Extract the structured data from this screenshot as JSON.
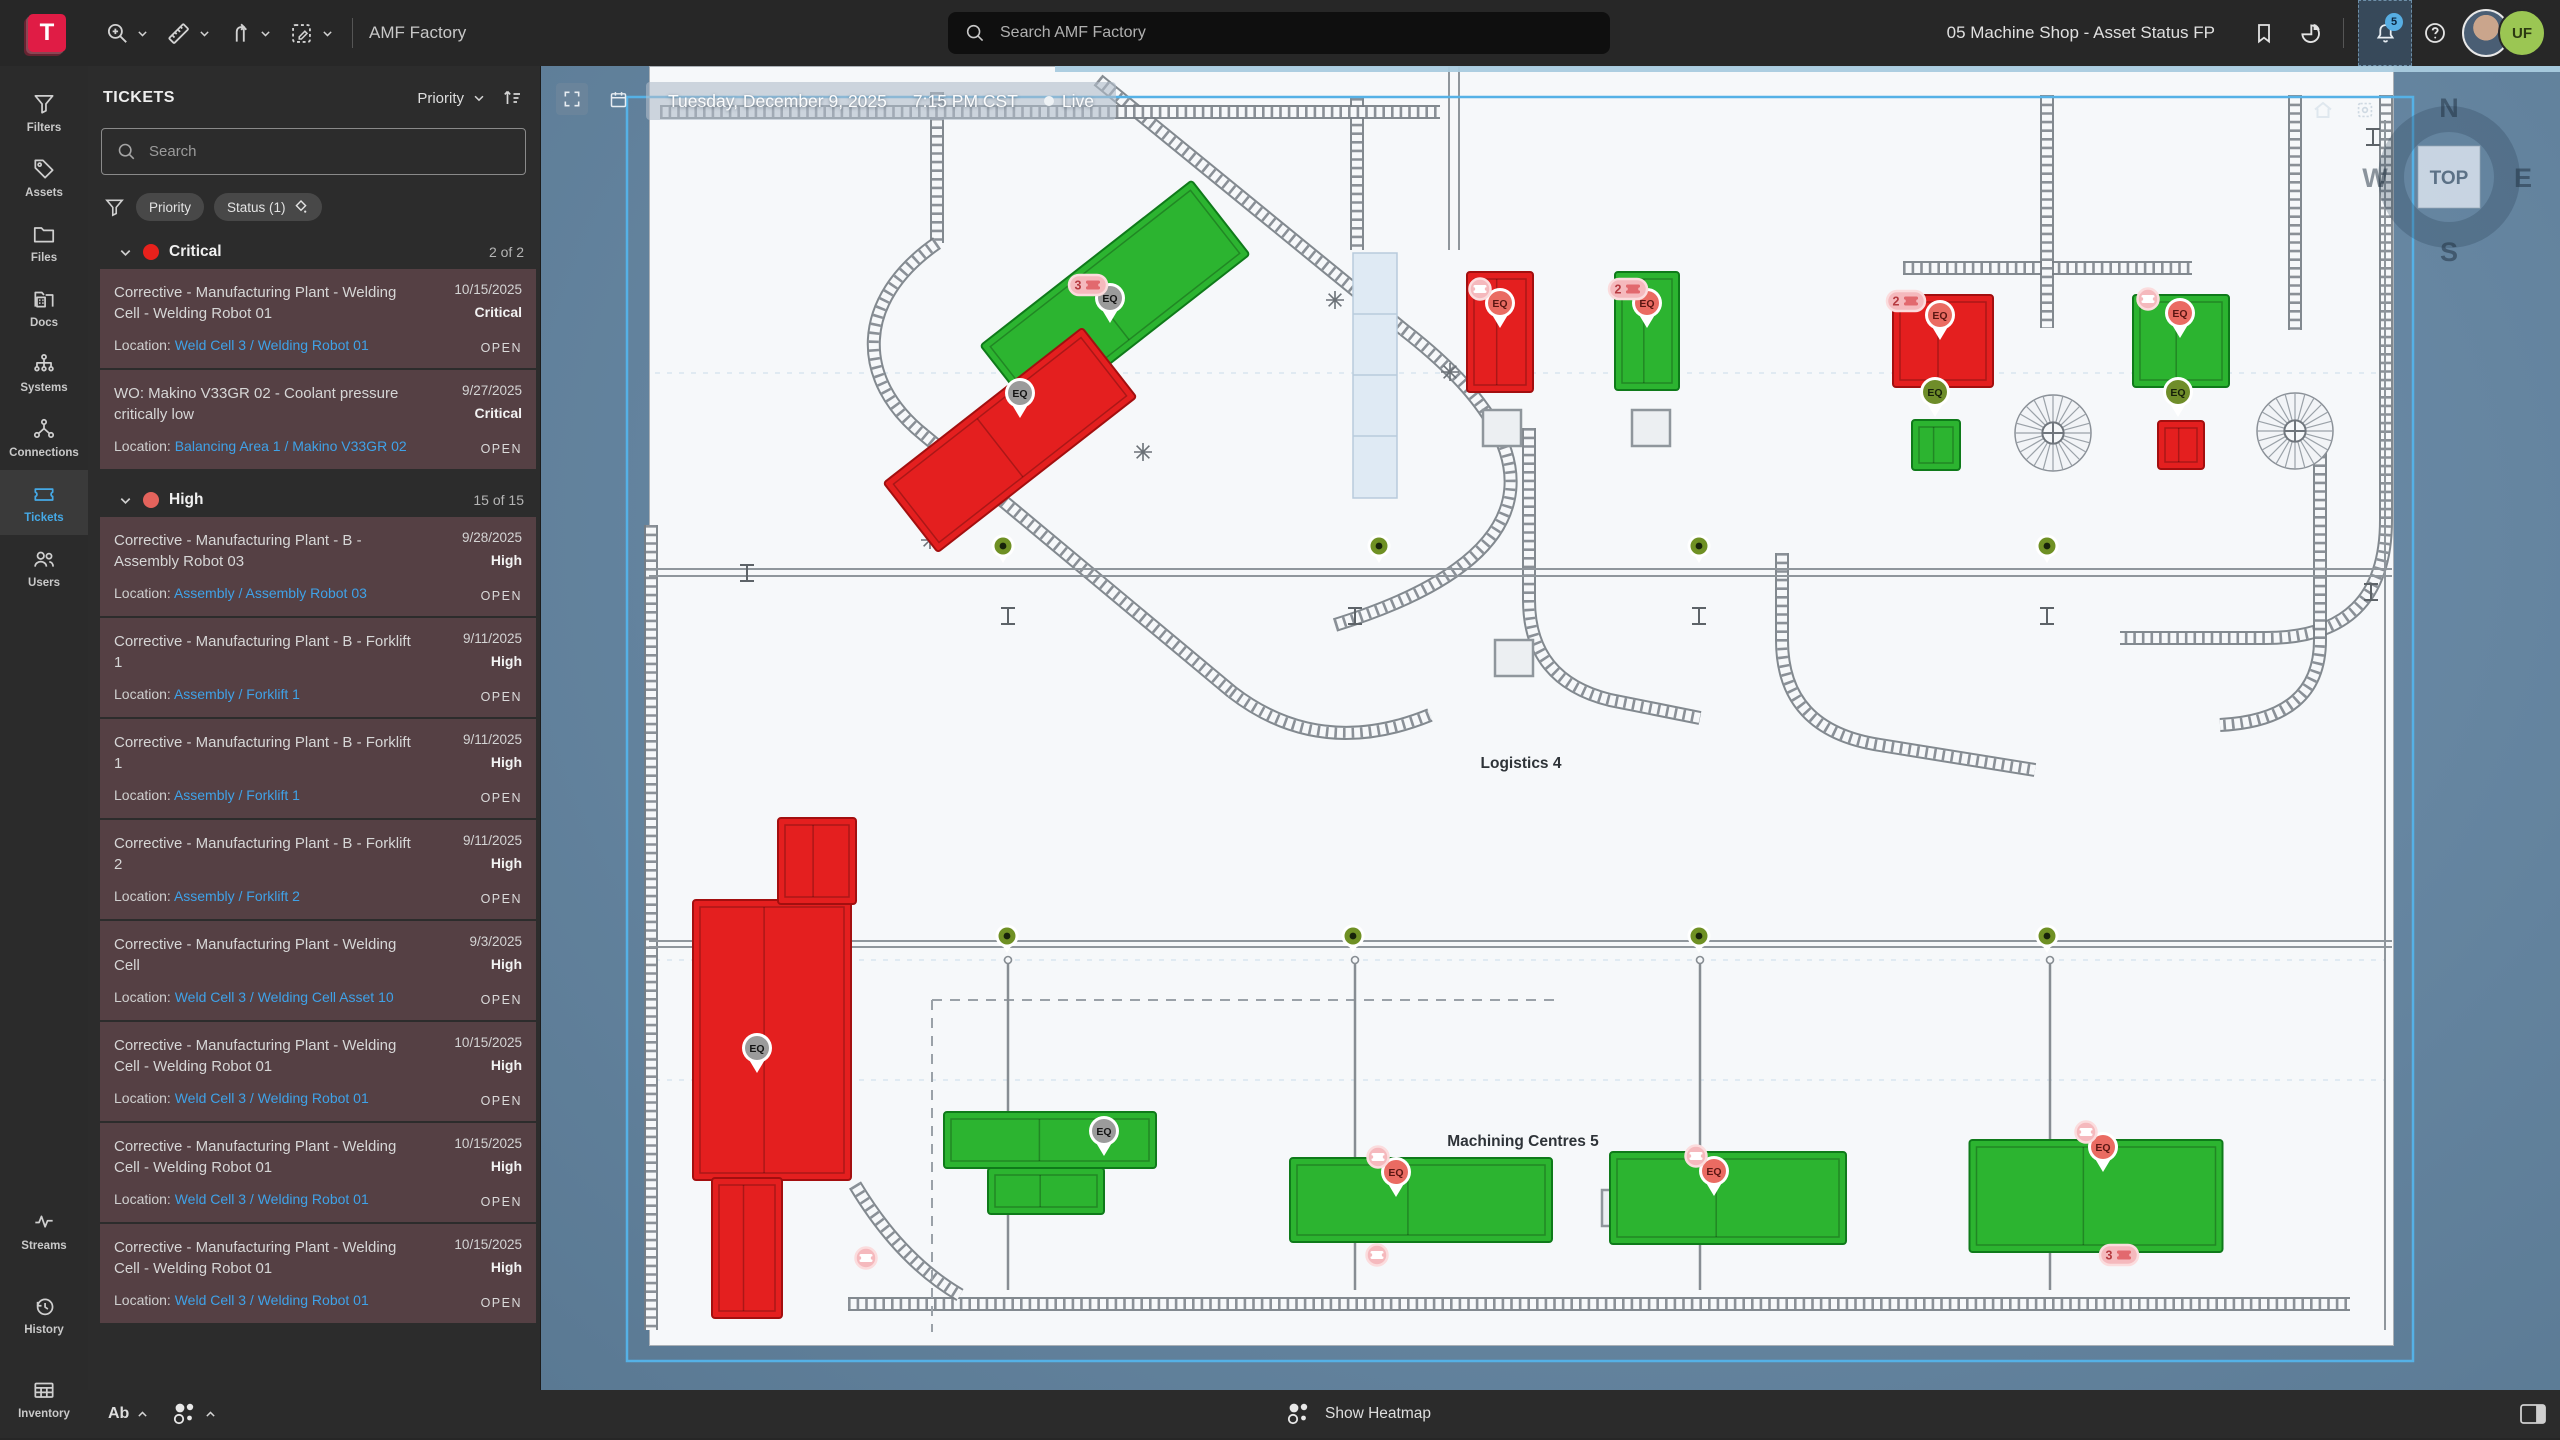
{
  "topbar": {
    "app_name": "AMF Factory",
    "search_placeholder": "Search AMF Factory",
    "view_title": "05 Machine Shop - Asset Status FP",
    "bell_badge": "5",
    "avatar_initials": "UF"
  },
  "sidebar": {
    "main": [
      {
        "id": "filters",
        "label": "Filters",
        "icon": "funnel",
        "active": false
      },
      {
        "id": "assets",
        "label": "Assets",
        "icon": "tag",
        "active": false
      },
      {
        "id": "files",
        "label": "Files",
        "icon": "folder",
        "active": false
      },
      {
        "id": "docs",
        "label": "Docs",
        "icon": "docs",
        "active": false
      },
      {
        "id": "systems",
        "label": "Systems",
        "icon": "systems",
        "active": false
      },
      {
        "id": "connections",
        "label": "Connections",
        "icon": "connections",
        "active": false
      },
      {
        "id": "tickets",
        "label": "Tickets",
        "icon": "ticket",
        "active": true
      },
      {
        "id": "users",
        "label": "Users",
        "icon": "users",
        "active": false
      }
    ],
    "lower": [
      {
        "id": "streams",
        "label": "Streams",
        "icon": "pulse",
        "active": false
      },
      {
        "id": "history",
        "label": "History",
        "icon": "history",
        "active": false
      },
      {
        "id": "inventory",
        "label": "Inventory",
        "icon": "grid",
        "active": false
      }
    ]
  },
  "panel": {
    "title": "TICKETS",
    "sort_label": "Priority",
    "search_placeholder": "Search",
    "filters": [
      "Priority",
      "Status (1)"
    ],
    "location_label": "Location:",
    "sections": [
      {
        "name": "Critical",
        "count": "2 of 2",
        "dot_color": "#e8211c",
        "tickets": [
          {
            "title": "Corrective - Manufacturing Plant - Welding Cell - Welding Robot 01",
            "date": "10/15/2025",
            "priority": "Critical",
            "location": "Weld Cell 3 / Welding Robot 01",
            "status": "OPEN"
          },
          {
            "title": "WO: Makino V33GR 02 - Coolant pressure critically low",
            "date": "9/27/2025",
            "priority": "Critical",
            "location": "Balancing Area 1 / Makino V33GR 02",
            "status": "OPEN"
          }
        ]
      },
      {
        "name": "High",
        "count": "15 of 15",
        "dot_color": "#e4635c",
        "tickets": [
          {
            "title": "Corrective - Manufacturing Plant - B - Assembly Robot 03",
            "date": "9/28/2025",
            "priority": "High",
            "location": "Assembly / Assembly Robot 03",
            "status": "OPEN"
          },
          {
            "title": "Corrective - Manufacturing Plant - B - Forklift 1",
            "date": "9/11/2025",
            "priority": "High",
            "location": "Assembly / Forklift 1",
            "status": "OPEN"
          },
          {
            "title": "Corrective - Manufacturing Plant - B - Forklift 1",
            "date": "9/11/2025",
            "priority": "High",
            "location": "Assembly / Forklift 1",
            "status": "OPEN"
          },
          {
            "title": "Corrective - Manufacturing Plant - B - Forklift 2",
            "date": "9/11/2025",
            "priority": "High",
            "location": "Assembly / Forklift 2",
            "status": "OPEN"
          },
          {
            "title": "Corrective - Manufacturing Plant - Welding Cell",
            "date": "9/3/2025",
            "priority": "High",
            "location": "Weld Cell 3 / Welding Cell Asset 10",
            "status": "OPEN"
          },
          {
            "title": "Corrective - Manufacturing Plant - Welding Cell - Welding Robot 01",
            "date": "10/15/2025",
            "priority": "High",
            "location": "Weld Cell 3 / Welding Robot 01",
            "status": "OPEN"
          },
          {
            "title": "Corrective - Manufacturing Plant - Welding Cell - Welding Robot 01",
            "date": "10/15/2025",
            "priority": "High",
            "location": "Weld Cell 3 / Welding Robot 01",
            "status": "OPEN"
          },
          {
            "title": "Corrective - Manufacturing Plant - Welding Cell - Welding Robot 01",
            "date": "10/15/2025",
            "priority": "High",
            "location": "Weld Cell 3 / Welding Robot 01",
            "status": "OPEN"
          }
        ]
      }
    ]
  },
  "map": {
    "banner": {
      "date": "Tuesday, December 9, 2025",
      "time": "7:15 PM CST",
      "live": "Live"
    },
    "compass": {
      "n": "N",
      "e": "E",
      "s": "S",
      "w": "W",
      "top": "TOP"
    },
    "colors": {
      "machine_green": "#2cb430",
      "machine_red": "#e41f1f",
      "pin_gray": "#9b9b9b",
      "pin_red": "#ea6b62",
      "pin_olive": "#6f8d2a",
      "badge": "#f5b9bd",
      "frame": "#55b1e6"
    },
    "zone_labels": [
      {
        "text": "Logistics 4",
        "x": 1521,
        "y": 768
      },
      {
        "text": "Machining Centres 5",
        "x": 1523,
        "y": 1146
      }
    ],
    "machines": [
      {
        "cx": 1115,
        "cy": 300,
        "w": 268,
        "h": 94,
        "rot": -38,
        "color": "green"
      },
      {
        "cx": 1010,
        "cy": 440,
        "w": 252,
        "h": 88,
        "rot": -38,
        "color": "red"
      },
      {
        "cx": 1500,
        "cy": 332,
        "w": 66,
        "h": 120,
        "rot": 0,
        "color": "red"
      },
      {
        "cx": 1647,
        "cy": 331,
        "w": 64,
        "h": 118,
        "rot": 0,
        "color": "green"
      },
      {
        "cx": 1943,
        "cy": 341,
        "w": 100,
        "h": 92,
        "rot": 0,
        "color": "red"
      },
      {
        "cx": 2181,
        "cy": 341,
        "w": 96,
        "h": 92,
        "rot": 0,
        "color": "green"
      },
      {
        "cx": 1936,
        "cy": 445,
        "w": 48,
        "h": 50,
        "rot": 0,
        "color": "green"
      },
      {
        "cx": 2181,
        "cy": 445,
        "w": 46,
        "h": 48,
        "rot": 0,
        "color": "red"
      },
      {
        "cx": 772,
        "cy": 1040,
        "w": 158,
        "h": 280,
        "rot": 0,
        "color": "red"
      },
      {
        "cx": 817,
        "cy": 861,
        "w": 78,
        "h": 86,
        "rot": 0,
        "color": "red"
      },
      {
        "cx": 747,
        "cy": 1248,
        "w": 70,
        "h": 140,
        "rot": 0,
        "color": "red"
      },
      {
        "cx": 1050,
        "cy": 1140,
        "w": 212,
        "h": 56,
        "rot": 0,
        "color": "green"
      },
      {
        "cx": 1046,
        "cy": 1191,
        "w": 116,
        "h": 46,
        "rot": 0,
        "color": "green"
      },
      {
        "cx": 1421,
        "cy": 1200,
        "w": 262,
        "h": 84,
        "rot": 0,
        "color": "green"
      },
      {
        "cx": 1728,
        "cy": 1198,
        "w": 236,
        "h": 92,
        "rot": 0,
        "color": "green"
      },
      {
        "cx": 2096,
        "cy": 1196,
        "w": 253,
        "h": 112,
        "rot": 0,
        "color": "green"
      }
    ],
    "eq_pins": [
      {
        "x": 1110,
        "y": 298,
        "kind": "gray"
      },
      {
        "x": 1020,
        "y": 393,
        "kind": "gray"
      },
      {
        "x": 757,
        "y": 1048,
        "kind": "gray"
      },
      {
        "x": 1104,
        "y": 1131,
        "kind": "gray"
      },
      {
        "x": 1500,
        "y": 303,
        "kind": "red"
      },
      {
        "x": 1647,
        "y": 303,
        "kind": "red"
      },
      {
        "x": 1940,
        "y": 315,
        "kind": "red"
      },
      {
        "x": 2180,
        "y": 313,
        "kind": "red"
      },
      {
        "x": 1396,
        "y": 1172,
        "kind": "red"
      },
      {
        "x": 1714,
        "y": 1171,
        "kind": "red"
      },
      {
        "x": 2103,
        "y": 1147,
        "kind": "red"
      },
      {
        "x": 1935,
        "y": 392,
        "kind": "olive"
      },
      {
        "x": 2178,
        "y": 392,
        "kind": "olive"
      }
    ],
    "ticket_badges": [
      {
        "x": 1088,
        "y": 285,
        "count": "3"
      },
      {
        "x": 1480,
        "y": 289,
        "count": ""
      },
      {
        "x": 1628,
        "y": 289,
        "count": "2"
      },
      {
        "x": 1906,
        "y": 301,
        "count": "2"
      },
      {
        "x": 2148,
        "y": 299,
        "count": ""
      },
      {
        "x": 1378,
        "y": 1157,
        "count": ""
      },
      {
        "x": 1696,
        "y": 1156,
        "count": ""
      },
      {
        "x": 2086,
        "y": 1132,
        "count": ""
      },
      {
        "x": 866,
        "y": 1258,
        "count": ""
      },
      {
        "x": 1377,
        "y": 1255,
        "count": ""
      },
      {
        "x": 2119,
        "y": 1255,
        "count": "3"
      }
    ],
    "status_dots": [
      {
        "x": 1003,
        "y": 546
      },
      {
        "x": 1379,
        "y": 546
      },
      {
        "x": 1699,
        "y": 546
      },
      {
        "x": 2047,
        "y": 546
      },
      {
        "x": 1007,
        "y": 936
      },
      {
        "x": 1353,
        "y": 936
      },
      {
        "x": 1699,
        "y": 936
      },
      {
        "x": 2047,
        "y": 936
      }
    ]
  },
  "bottombar": {
    "ab_label": "Ab",
    "heatmap_label": "Show Heatmap"
  }
}
